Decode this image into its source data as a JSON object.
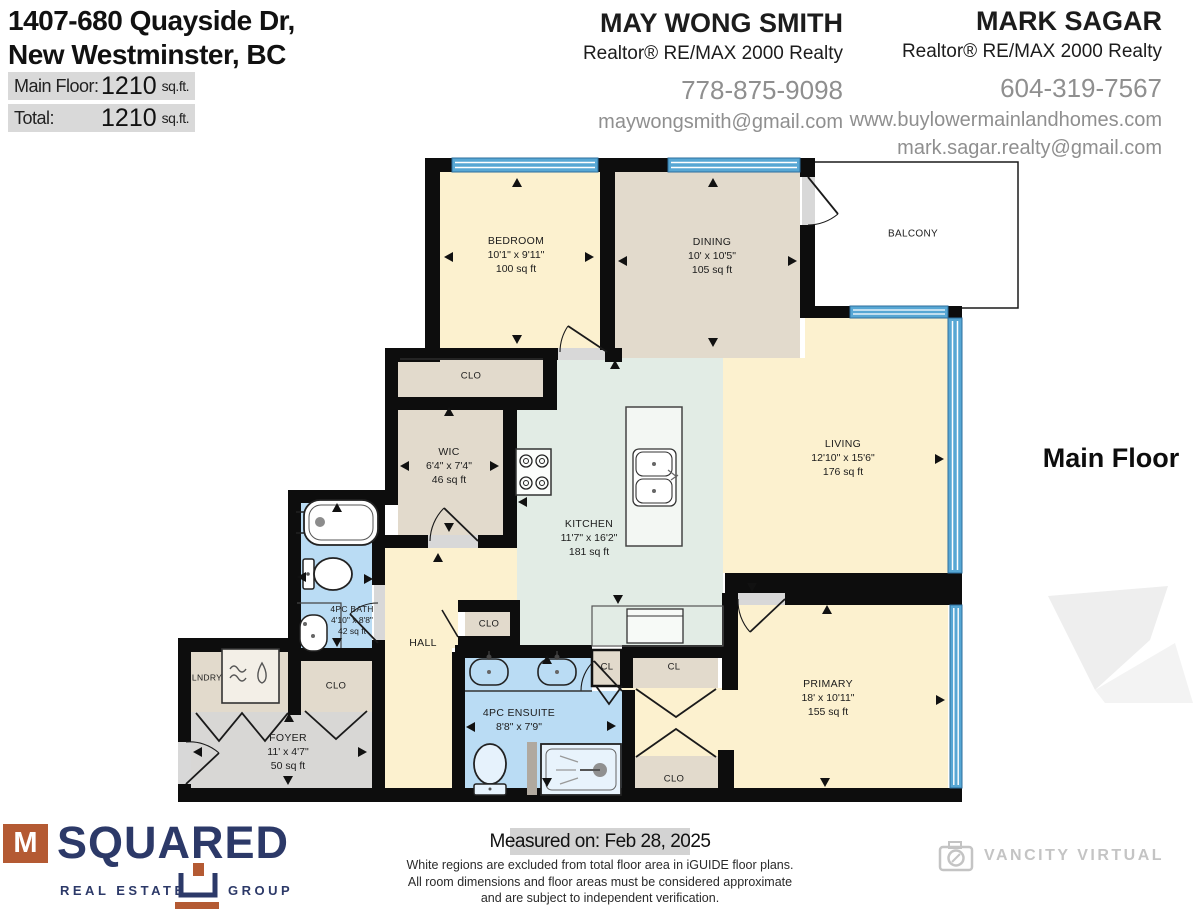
{
  "header": {
    "address1": "1407-680 Quayside Dr,",
    "address2": "New Westminster, BC",
    "area_rows": [
      {
        "label": "Main Floor:",
        "value": "1210",
        "unit": "sq.ft."
      },
      {
        "label": "Total:",
        "value": "1210",
        "unit": "sq.ft."
      }
    ],
    "agents": [
      {
        "name": "MAY WONG SMITH",
        "title": "Realtor® RE/MAX 2000 Realty",
        "phone": "778-875-9098",
        "email": "maywongsmith@gmail.com"
      },
      {
        "name": "MARK SAGAR",
        "title": "Realtor® RE/MAX 2000 Realty",
        "phone": "604-319-7567",
        "website": "www.buylowermainlandhomes.com",
        "email": "mark.sagar.realty@gmail.com"
      }
    ]
  },
  "plan": {
    "floor_title": "Main Floor",
    "colors": {
      "room_cream": "#fcf1cf",
      "room_beige": "#e2dacc",
      "room_mint": "#e2ece5",
      "room_blue": "#badcf4",
      "room_gray": "#d8d7d5",
      "wall": "#0d0d0d",
      "window_blue": "#57a7d4"
    },
    "rooms": [
      {
        "name": "BEDROOM",
        "dims": "10'1\" x 9'11\"",
        "area": "100 sq ft"
      },
      {
        "name": "DINING",
        "dims": "10' x 10'5\"",
        "area": "105 sq ft"
      },
      {
        "name": "BALCONY"
      },
      {
        "name": "LIVING",
        "dims": "12'10\" x 15'6\"",
        "area": "176 sq ft"
      },
      {
        "name": "WIC",
        "dims": "6'4\" x 7'4\"",
        "area": "46 sq ft"
      },
      {
        "name": "KITCHEN",
        "dims": "11'7\" x 16'2\"",
        "area": "181 sq ft"
      },
      {
        "name": "4PC BATH",
        "dims": "4'10\" x 8'8\"",
        "area": "42 sq ft"
      },
      {
        "name": "HALL"
      },
      {
        "name": "LNDRY"
      },
      {
        "name": "CLO"
      },
      {
        "name": "CLO"
      },
      {
        "name": "FOYER",
        "dims": "11' x 4'7\"",
        "area": "50 sq ft"
      },
      {
        "name": "4PC ENSUITE",
        "dims": "8'8\" x 7'9\""
      },
      {
        "name": "CL"
      },
      {
        "name": "CL"
      },
      {
        "name": "CLO"
      },
      {
        "name": "CLO"
      },
      {
        "name": "PRIMARY",
        "dims": "18' x 10'11\"",
        "area": "155 sq ft"
      }
    ]
  },
  "footer": {
    "measured": "Measured on: Feb 28, 2025",
    "disclaimer": [
      "White regions are excluded from total floor area in iGUIDE floor plans.",
      "All room dimensions and floor areas must be considered approximate",
      "and are subject to independent verification."
    ],
    "msquared": {
      "letter": "M",
      "word": "SQUARED",
      "left": "REAL ESTATE",
      "right": "GROUP"
    },
    "vancity": "VANCITY VIRTUAL"
  }
}
